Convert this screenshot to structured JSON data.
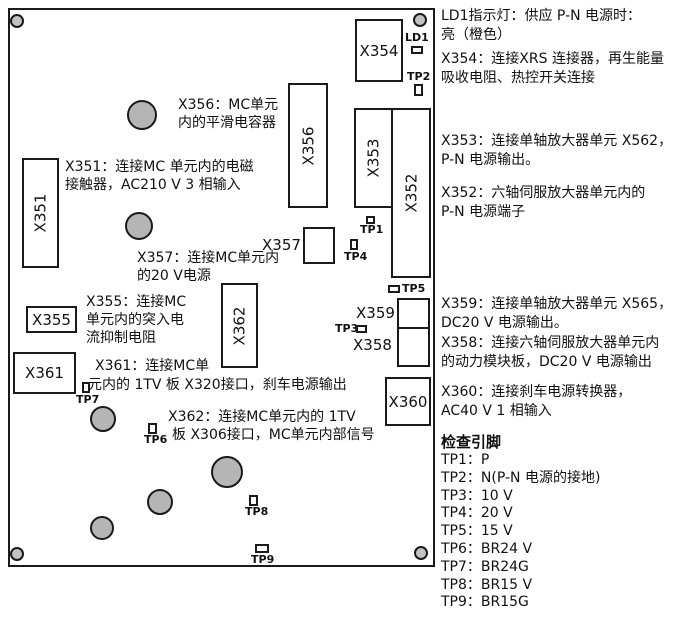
{
  "board": {
    "connectors": {
      "x351": "X351",
      "x352": "X352",
      "x353": "X353",
      "x354": "X354",
      "x355": "X355",
      "x356": "X356",
      "x357": "X357",
      "x358": "X358",
      "x359": "X359",
      "x360": "X360",
      "x361": "X361",
      "x362": "X362"
    },
    "led": {
      "label": "LD1"
    },
    "test_points": {
      "tp1": "TP1",
      "tp2": "TP2",
      "tp3": "TP3",
      "tp4": "TP4",
      "tp5": "TP5",
      "tp6": "TP6",
      "tp7": "TP7",
      "tp8": "TP8",
      "tp9": "TP9"
    },
    "annotations": {
      "x356": "X356：MC单元\n内的平滑电容器",
      "x351": "X351：连接MC 单元内的电磁\n接触器，AC210 V 3 相输入",
      "x357": "X357：连接MC单元内\n的20 V电源",
      "x355": "X355：连接MC\n单元内的突入电\n流抑制电阻",
      "x361_line1": "X361：连接MC单",
      "x361_line2": "元内的 1TV 板 X320接口，刹车电源输出",
      "x362_line1": "X362：连接MC单元内的 1TV",
      "x362_line2": "板 X306接口，MC单元内部信号"
    }
  },
  "legend": {
    "notes": {
      "ld1": "LD1指示灯：供应 P-N 电源时：\n亮（橙色）",
      "x354": "X354：连接XRS 连接器，再生能量\n吸收电阻、热控开关连接",
      "x353": "X353：连接单轴放大器单元 X562，\nP-N 电源输出。",
      "x352": "X352：六轴伺服放大器单元内的\n P-N 电源端子",
      "x359": "X359：连接单轴放大器单元 X565，\nDC20 V 电源输出。",
      "x358": "X358：连接六轴伺服放大器单元内\n的动力模块板，DC20 V 电源输出",
      "x360": "X360：连接刹车电源转换器，\nAC40 V 1 相输入"
    },
    "check_pins": {
      "heading": "检查引脚",
      "items": [
        "TP1：P",
        "TP2：N(P-N 电源的接地)",
        "TP3：10 V",
        "TP4：20 V",
        "TP5：15 V",
        "TP6：BR24 V",
        "TP7：BR24G",
        "TP8：BR15 V",
        "TP9：BR15G"
      ]
    }
  },
  "colors": {
    "background": "#ffffff",
    "line": "#1a1a1a",
    "hole_fill": "#b5b5b5",
    "screw_fill": "#c2c2c2"
  }
}
